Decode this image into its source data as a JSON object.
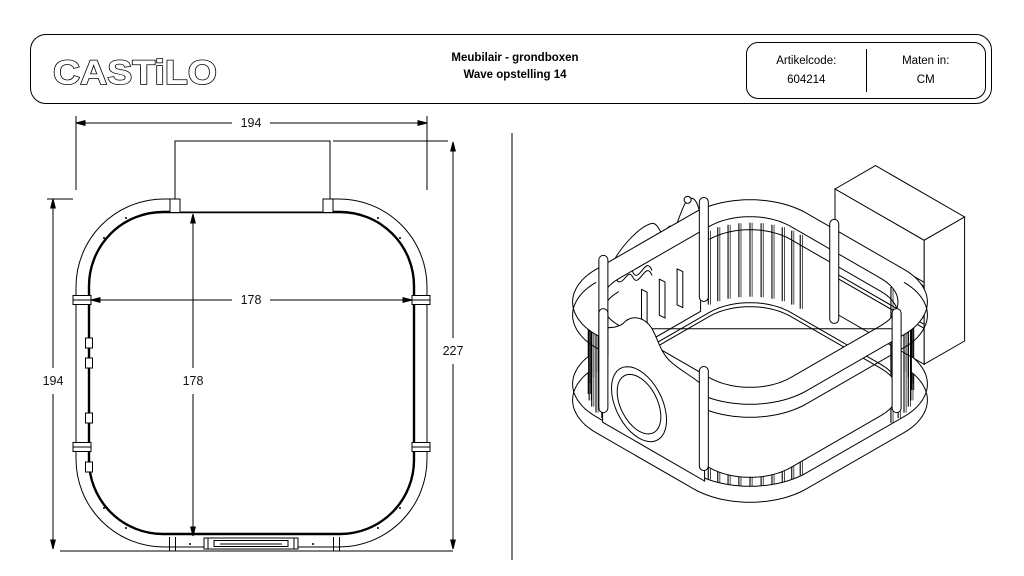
{
  "header": {
    "logo_text": "CASTiLO",
    "title_line1": "Meubilair - grondboxen",
    "title_line2": "Wave opstelling 14",
    "artikelcode_label": "Artikelcode:",
    "artikelcode_value": "604214",
    "maten_label": "Maten in:",
    "maten_value": "CM"
  },
  "plan": {
    "dim_top_width": "194",
    "dim_left_height": "194",
    "dim_total_height": "227",
    "dim_inner_width": "178",
    "dim_inner_height": "178"
  },
  "colors": {
    "line": "#000000",
    "background": "#ffffff"
  }
}
